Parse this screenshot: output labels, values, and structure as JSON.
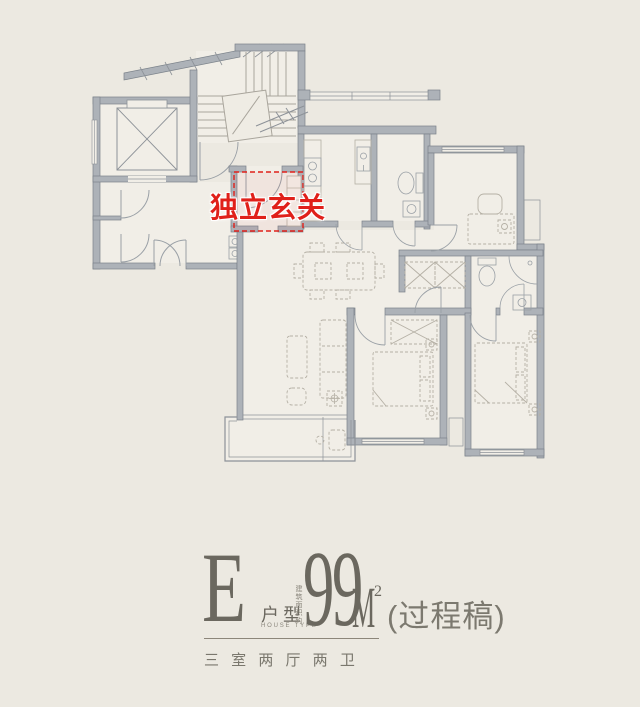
{
  "colors": {
    "background": "#ece9e1",
    "room_fill": "#f1eee7",
    "wall_fill": "#adb2b8",
    "wall_stroke": "#7b828a",
    "fixture_line": "#9aa0a6",
    "furniture_line": "#b5b0a5",
    "accent_red": "#e0201a",
    "text": "#6b685f",
    "muted_text": "#8a867c"
  },
  "callout": {
    "label": "独立玄关"
  },
  "title_block": {
    "type_letter": "E",
    "type_label": "户型",
    "type_label_en": "HOUSE TYPE",
    "area_note": "建筑面积约",
    "area_value": "99",
    "area_unit": "M",
    "area_exponent": "2",
    "draft_note": "(过程稿)",
    "rooms_summary": "三 室 两 厅 两 卫"
  }
}
